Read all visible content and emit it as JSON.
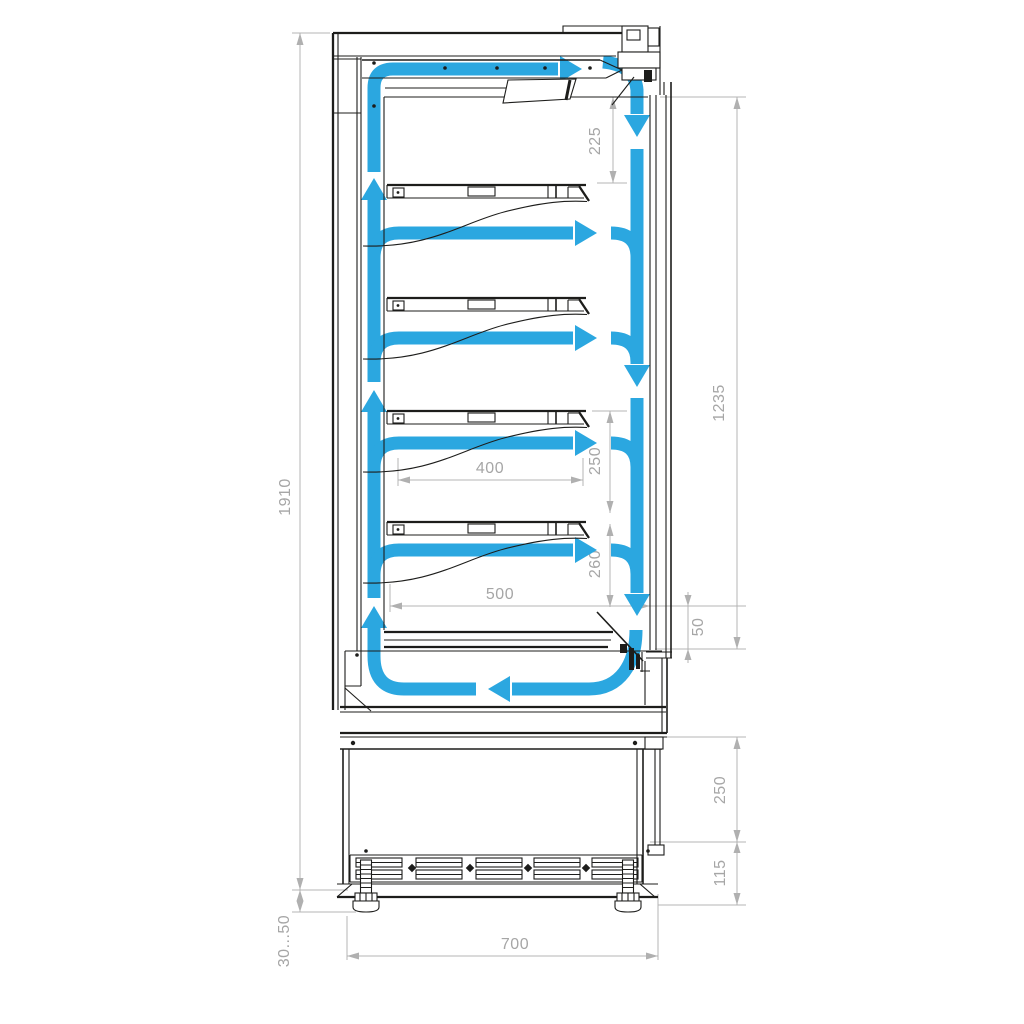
{
  "colors": {
    "flow_arrows": "#2ba7e0",
    "line_work": "#1d1d1b",
    "dimension_lines": "#b4b4b4",
    "dimension_text": "#a6a6a6",
    "background": "#ffffff"
  },
  "dimensions": {
    "overall_height": "1910",
    "adjustable_feet": "30...50",
    "overall_depth": "700",
    "top_duct_gap": "225",
    "display_opening": "1235",
    "shelf_pitch_upper": "250",
    "shelf_pitch_lower": "260",
    "shelf_depth": "400",
    "base_shelf_depth": "500",
    "air_return_gap": "50",
    "base_section_height": "250",
    "grille_height": "115"
  }
}
